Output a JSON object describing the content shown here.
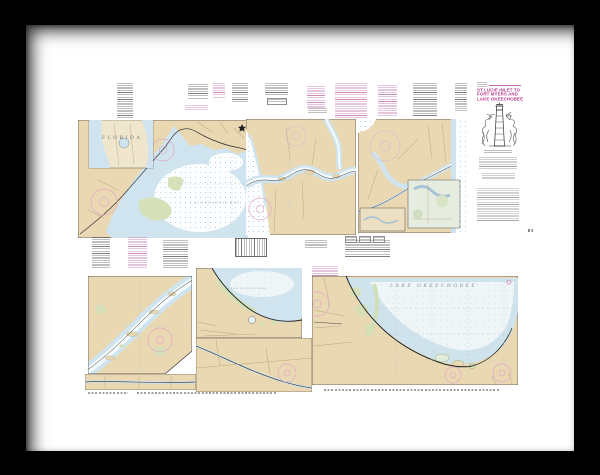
{
  "artwork": {
    "kind": "framed nautical chart print",
    "frame_color": "#000000",
    "mat_color": "#ffffff",
    "paper_color": "#ffffff"
  },
  "chart": {
    "title_block": {
      "lines": [
        "ST LUCIE INLET TO",
        "FORT MYERS AND",
        "LAKE OKEECHOBEE"
      ],
      "title_color": "#b5368d"
    },
    "labels": {
      "main_water": "CALOOSAHATCHEE",
      "state_inset": "FLORIDA",
      "lake_main": "LAKE OKEECHOBEE",
      "lake_inset": "LAKE OKEECHOBEE"
    },
    "palette": {
      "land": "#e9d8b2",
      "shallow_water": "#cfe4ee",
      "open_water": "#fdfeff",
      "lake_center": "#f0f6f8",
      "marsh": "#d6e1ba",
      "compass_rose": "#e2a9c9",
      "magenta_print": "#c06fae",
      "black_print": "#5f5f5f"
    }
  }
}
